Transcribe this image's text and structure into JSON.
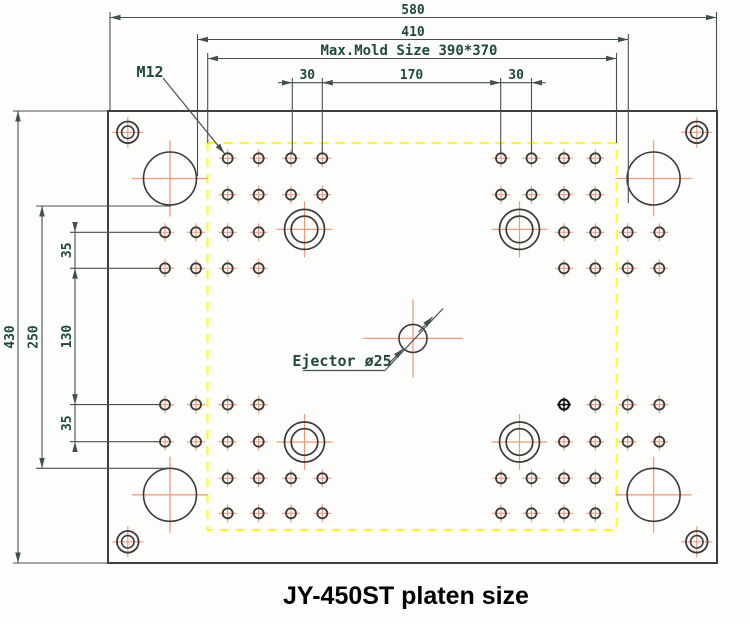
{
  "page": {
    "title": "JY-450ST platen size"
  },
  "annotations": {
    "thread_label": "M12",
    "ejector_label": "Ejector ø25",
    "mold_size_label": "Max.Mold Size 390*370"
  },
  "dimensions": {
    "width_overall": "580",
    "width_inner": "410",
    "hpitch_left": "30",
    "hpitch_center": "170",
    "hpitch_right": "30",
    "height_overall": "430",
    "height_inner": "250",
    "vpitch_top": "35",
    "vpitch_center": "130",
    "vpitch_bottom": "35"
  },
  "colors": {
    "dim_line": "#42524a",
    "dim_text": "#1d4a3a",
    "hole_stroke": "#3a3a3a",
    "crosshair": "#f09b7b",
    "mold_area": "#ffff00",
    "plate_stroke": "#3f3f3f",
    "plate_fill": "#fdfdfb",
    "title_text": "#000000",
    "special_hole": "#141414"
  },
  "geometry": {
    "plate": {
      "x": 108,
      "y": 111,
      "w": 609,
      "h": 452
    },
    "mold_area": {
      "x": 207.5,
      "y": 143,
      "w": 409,
      "h": 387
    },
    "small_hole": {
      "r": 5,
      "arm": 9
    },
    "small_holes": [
      [
        227.7,
        158.3
      ],
      [
        258.7,
        158.3
      ],
      [
        291,
        158.3
      ],
      [
        322.3,
        158.3
      ],
      [
        227.7,
        194.7
      ],
      [
        258.7,
        194.7
      ],
      [
        291,
        194.7
      ],
      [
        322.3,
        194.7
      ],
      [
        165,
        232.3
      ],
      [
        196,
        232.3
      ],
      [
        227.7,
        232.3
      ],
      [
        258.7,
        232.3
      ],
      [
        165,
        268.3
      ],
      [
        196,
        268.3
      ],
      [
        227.7,
        268.3
      ],
      [
        258.7,
        268.3
      ],
      [
        501,
        158.3
      ],
      [
        531.5,
        158.3
      ],
      [
        564,
        158.3
      ],
      [
        595.3,
        158.3
      ],
      [
        501,
        194.7
      ],
      [
        531.5,
        194.7
      ],
      [
        564,
        194.7
      ],
      [
        595.3,
        194.7
      ],
      [
        564,
        232.3
      ],
      [
        595.3,
        232.3
      ],
      [
        627.7,
        232.3
      ],
      [
        659.3,
        232.3
      ],
      [
        564,
        268.3
      ],
      [
        595.3,
        268.3
      ],
      [
        627.7,
        268.3
      ],
      [
        659.3,
        268.3
      ],
      [
        165,
        404.6
      ],
      [
        196,
        404.6
      ],
      [
        227.7,
        404.6
      ],
      [
        258.7,
        404.6
      ],
      [
        165,
        441.7
      ],
      [
        196,
        441.7
      ],
      [
        227.7,
        441.7
      ],
      [
        258.7,
        441.7
      ],
      [
        227.7,
        478.3
      ],
      [
        258.7,
        478.3
      ],
      [
        291,
        478.3
      ],
      [
        322.3,
        478.3
      ],
      [
        227.7,
        513.3
      ],
      [
        258.7,
        513.3
      ],
      [
        291,
        513.3
      ],
      [
        322.3,
        513.3
      ],
      [
        595.3,
        404.6
      ],
      [
        627.7,
        404.6
      ],
      [
        659.3,
        404.6
      ],
      [
        564,
        441.7
      ],
      [
        595.3,
        441.7
      ],
      [
        627.7,
        441.7
      ],
      [
        659.3,
        441.7
      ],
      [
        501,
        478.3
      ],
      [
        531.5,
        478.3
      ],
      [
        564,
        478.3
      ],
      [
        595.3,
        478.3
      ],
      [
        501,
        513.3
      ],
      [
        531.5,
        513.3
      ],
      [
        564,
        513.3
      ],
      [
        595.3,
        513.3
      ]
    ],
    "special_hole": {
      "cx": 564,
      "cy": 404.6,
      "r": 5,
      "arm": 7
    },
    "ring_holes": {
      "r_outer": 20,
      "r_inner": 13.3,
      "arm": 28,
      "centers": [
        [
          304.5,
          229.4
        ],
        [
          519.5,
          229.4
        ],
        [
          304.5,
          442
        ],
        [
          519.5,
          442
        ]
      ]
    },
    "tie_bar_holes": {
      "r": 26.5,
      "arm": 38,
      "centers": [
        [
          170,
          178.5
        ],
        [
          653.6,
          178.5
        ],
        [
          170,
          494.8
        ],
        [
          653.6,
          494.8
        ]
      ]
    },
    "corner_holes": {
      "r_outer": 10.8,
      "r_inner": 6.2,
      "arm": 15.5,
      "centers": [
        [
          127.8,
          132.3
        ],
        [
          696.8,
          132.3
        ],
        [
          127.8,
          541.8
        ],
        [
          696.8,
          541.8
        ]
      ]
    },
    "ejector": {
      "cx": 413,
      "cy": 338.4,
      "r": 14,
      "h_arm": 50,
      "v_arm": 39
    }
  }
}
